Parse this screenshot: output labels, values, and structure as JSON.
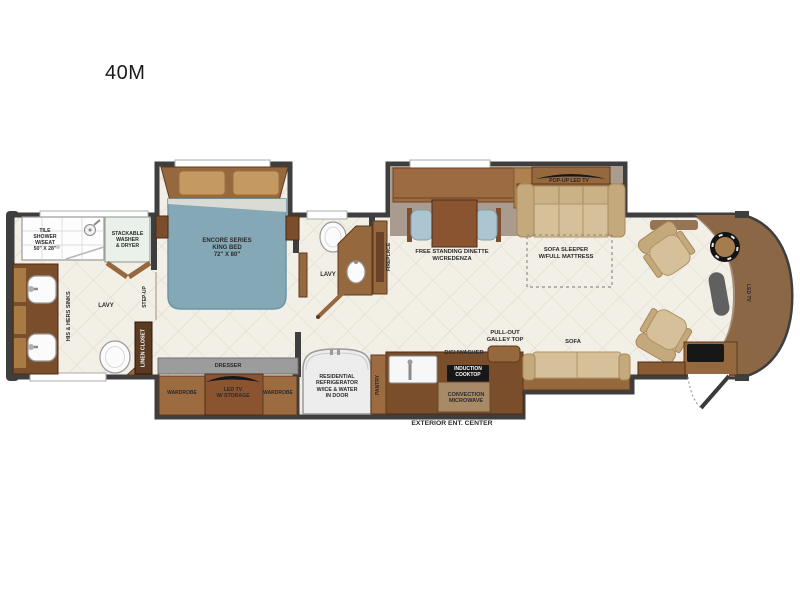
{
  "title": "40M",
  "colors": {
    "wall": "#3E3E3E",
    "floor": "#F2EFE7",
    "slide_floor": "#A99C8F",
    "wood": "#96683E",
    "wood_dark": "#7A4E2B",
    "wood_deep": "#5F3A1D",
    "wood_light": "#B08050",
    "cabinet": "#9C6B3F",
    "tan": "#D6C099",
    "tan_dark": "#C3A97C",
    "bed_teal": "#84A8B6",
    "chair_blue": "#ADC5D0",
    "cap": "#8C6746",
    "ink": "#171717"
  },
  "labels": {
    "bath": {
      "tile_shower": "TILE\nSHOWER\nW/SEAT\n50\" X 28\"",
      "stackable_washer": "STACKABLE\nWASHER\n& DRYER",
      "his_hers_sinks": "HIS & HERS SINKS",
      "lavy": "LAVY",
      "step_up": "STEP-UP",
      "linen_closet": "LINEN CLOSET"
    },
    "bedroom": {
      "bed": "ENCORE SERIES\nKING BED\n72\" X 80\"",
      "dresser": "DRESSER",
      "wardrobe_left": "WARDROBE",
      "led_tv_storage": "LED TV\nW/ STORAGE",
      "wardrobe_right": "WARDROBE"
    },
    "mid_bath": {
      "lavy": "LAVY",
      "fireplace": "FIREPLACE"
    },
    "living": {
      "dinette": "FREE STANDING DINETTE\nW/CREDENZA",
      "popup_tv": "POP-UP LED TV",
      "sofa_sleeper": "SOFA SLEEPER\nW/FULL MATTRESS"
    },
    "galley": {
      "refrigerator": "RESIDENTIAL\nREFRIGERATOR\nW/ICE & WATER\nIN DOOR",
      "pantry": "PANTRY",
      "dishwasher": "DISHWASHER",
      "induction_cooktop": "INDUCTION\nCOOKTOP",
      "convection_microwave": "CONVECTION\nMICROWAVE",
      "pullout_galley": "PULL-OUT\nGALLEY TOP",
      "sofa": "SOFA",
      "exterior_ent_center": "EXTERIOR ENT. CENTER"
    },
    "cockpit": {
      "led_tv": "LED TV"
    }
  }
}
